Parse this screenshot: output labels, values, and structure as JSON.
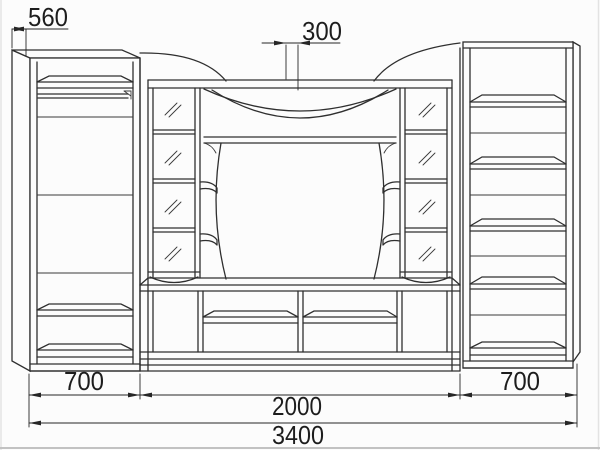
{
  "drawing": {
    "kind": "furniture-wall-unit-technical-drawing",
    "dimensions": {
      "depth": "560",
      "canopy_depth": "300",
      "left_width": "700",
      "center_width": "2000",
      "right_width": "700",
      "total_width": "3400"
    },
    "colors": {
      "line": "#2f2f2f",
      "dimension_text": "#1d1d1d",
      "background": "#fcfcfc"
    }
  }
}
